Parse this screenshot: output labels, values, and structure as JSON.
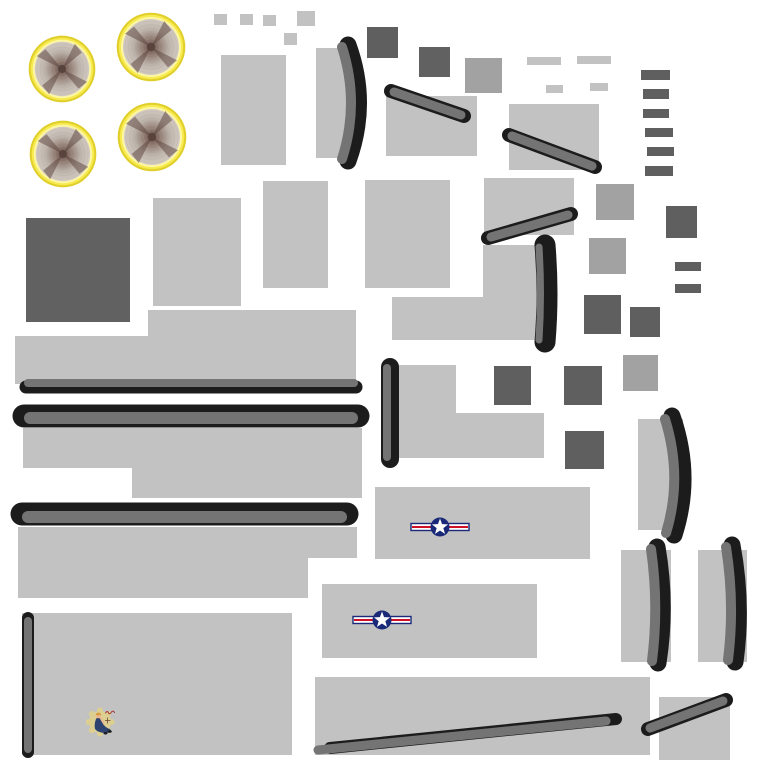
{
  "canvas": {
    "width": 768,
    "height": 768,
    "background": "#ffffff"
  },
  "palette": {
    "light": "#C2C2C2",
    "mid": "#A2A2A2",
    "dark": "#5F5F5F",
    "darker": "#616161",
    "strip": "#747474",
    "black": "#1C1C1C",
    "yellow_edge": "#E0CF2B",
    "yellow_ring": "#F7EA4F",
    "yellow_hi": "#FDF6A3",
    "disc_core": "#6E534B",
    "disc_mid": "#917C72",
    "disc_outer": "#D2CAC2",
    "ring_line": "#AFA49C",
    "prop_blur": "#5A423B",
    "insignia_blue": "#1B2A78",
    "insignia_red": "#CE1126",
    "insignia_white": "#FFFFFF",
    "gear_tan": "#DCCF90",
    "uniform_navy": "#2E4470",
    "skin": "#EBB98F",
    "hair": "#D79A3C",
    "script_red": "#A83232",
    "shoe_black": "#1A1A1A"
  },
  "engines": [
    {
      "cx": 62,
      "cy": 69,
      "r": 34
    },
    {
      "cx": 151,
      "cy": 47,
      "r": 35
    },
    {
      "cx": 63,
      "cy": 154,
      "r": 34
    },
    {
      "cx": 152,
      "cy": 137,
      "r": 35
    }
  ],
  "rects": [
    {
      "x": 214,
      "y": 14,
      "w": 13,
      "h": 11,
      "c": "light",
      "n": "small-panel-patch"
    },
    {
      "x": 240,
      "y": 14,
      "w": 13,
      "h": 11,
      "c": "light",
      "n": "small-panel-patch"
    },
    {
      "x": 263,
      "y": 15,
      "w": 13,
      "h": 11,
      "c": "light",
      "n": "small-panel-patch"
    },
    {
      "x": 297,
      "y": 11,
      "w": 18,
      "h": 15,
      "c": "light",
      "n": "small-panel-patch"
    },
    {
      "x": 284,
      "y": 33,
      "w": 13,
      "h": 12,
      "c": "light",
      "n": "small-panel-patch"
    },
    {
      "x": 221,
      "y": 55,
      "w": 65,
      "h": 110,
      "c": "light",
      "n": "panel-patch"
    },
    {
      "x": 316,
      "y": 48,
      "w": 40,
      "h": 110,
      "c": "light",
      "n": "blade-backing-patch"
    },
    {
      "x": 367,
      "y": 27,
      "w": 31,
      "h": 31,
      "c": "dark",
      "n": "dark-panel-patch"
    },
    {
      "x": 419,
      "y": 47,
      "w": 31,
      "h": 30,
      "c": "darker",
      "n": "dark-panel-patch"
    },
    {
      "x": 465,
      "y": 58,
      "w": 37,
      "h": 35,
      "c": "mid",
      "n": "mid-panel-patch"
    },
    {
      "x": 386,
      "y": 96,
      "w": 91,
      "h": 60,
      "c": "light",
      "n": "panel-patch"
    },
    {
      "x": 509,
      "y": 104,
      "w": 90,
      "h": 66,
      "c": "light",
      "n": "panel-patch"
    },
    {
      "x": 527,
      "y": 57,
      "w": 34,
      "h": 8,
      "c": "light",
      "n": "thin-panel-strip"
    },
    {
      "x": 577,
      "y": 56,
      "w": 34,
      "h": 8,
      "c": "light",
      "n": "thin-panel-strip"
    },
    {
      "x": 546,
      "y": 85,
      "w": 17,
      "h": 8,
      "c": "light",
      "n": "thin-panel-strip"
    },
    {
      "x": 590,
      "y": 83,
      "w": 18,
      "h": 8,
      "c": "light",
      "n": "thin-panel-strip"
    },
    {
      "x": 641,
      "y": 70,
      "w": 29,
      "h": 10,
      "c": "dark",
      "n": "dark-slat-patch"
    },
    {
      "x": 643,
      "y": 89,
      "w": 26,
      "h": 10,
      "c": "dark",
      "n": "dark-slat-patch"
    },
    {
      "x": 643,
      "y": 109,
      "w": 26,
      "h": 9,
      "c": "dark",
      "n": "dark-slat-patch"
    },
    {
      "x": 645,
      "y": 128,
      "w": 28,
      "h": 9,
      "c": "dark",
      "n": "dark-slat-patch"
    },
    {
      "x": 647,
      "y": 147,
      "w": 27,
      "h": 9,
      "c": "dark",
      "n": "dark-slat-patch"
    },
    {
      "x": 645,
      "y": 166,
      "w": 28,
      "h": 10,
      "c": "dark",
      "n": "dark-slat-patch"
    },
    {
      "x": 26,
      "y": 218,
      "w": 104,
      "h": 104,
      "c": "darker",
      "n": "large-dark-panel-patch"
    },
    {
      "x": 153,
      "y": 198,
      "w": 88,
      "h": 108,
      "c": "light",
      "n": "panel-patch"
    },
    {
      "x": 263,
      "y": 181,
      "w": 65,
      "h": 107,
      "c": "light",
      "n": "panel-patch"
    },
    {
      "x": 365,
      "y": 180,
      "w": 85,
      "h": 108,
      "c": "light",
      "n": "panel-patch"
    },
    {
      "x": 484,
      "y": 178,
      "w": 90,
      "h": 57,
      "c": "light",
      "n": "panel-patch"
    },
    {
      "x": 596,
      "y": 184,
      "w": 38,
      "h": 36,
      "c": "mid",
      "n": "mid-panel-patch"
    },
    {
      "x": 666,
      "y": 206,
      "w": 31,
      "h": 32,
      "c": "dark",
      "n": "dark-panel-patch"
    },
    {
      "x": 589,
      "y": 238,
      "w": 37,
      "h": 36,
      "c": "mid",
      "n": "mid-panel-patch"
    },
    {
      "x": 675,
      "y": 262,
      "w": 26,
      "h": 9,
      "c": "dark",
      "n": "dark-slat-patch"
    },
    {
      "x": 675,
      "y": 284,
      "w": 26,
      "h": 9,
      "c": "dark",
      "n": "dark-slat-patch"
    },
    {
      "x": 584,
      "y": 295,
      "w": 37,
      "h": 39,
      "c": "dark",
      "n": "dark-panel-patch"
    },
    {
      "x": 630,
      "y": 307,
      "w": 30,
      "h": 30,
      "c": "dark",
      "n": "dark-panel-patch"
    },
    {
      "x": 148,
      "y": 310,
      "w": 208,
      "h": 26,
      "c": "light",
      "n": "wing-panel-patch"
    },
    {
      "x": 15,
      "y": 336,
      "w": 341,
      "h": 48,
      "c": "light",
      "n": "wing-panel-patch"
    },
    {
      "x": 23,
      "y": 428,
      "w": 339,
      "h": 40,
      "c": "light",
      "n": "wing-panel-patch"
    },
    {
      "x": 132,
      "y": 468,
      "w": 230,
      "h": 30,
      "c": "light",
      "n": "wing-panel-patch"
    },
    {
      "x": 18,
      "y": 527,
      "w": 339,
      "h": 31,
      "c": "light",
      "n": "wing-panel-patch"
    },
    {
      "x": 18,
      "y": 558,
      "w": 290,
      "h": 40,
      "c": "light",
      "n": "wing-panel-patch"
    },
    {
      "x": 390,
      "y": 365,
      "w": 66,
      "h": 48,
      "c": "light",
      "n": "panel-patch"
    },
    {
      "x": 390,
      "y": 413,
      "w": 154,
      "h": 45,
      "c": "light",
      "n": "panel-patch"
    },
    {
      "x": 483,
      "y": 245,
      "w": 53,
      "h": 95,
      "c": "light",
      "n": "panel-patch"
    },
    {
      "x": 392,
      "y": 297,
      "w": 144,
      "h": 43,
      "c": "light",
      "n": "panel-patch"
    },
    {
      "x": 494,
      "y": 366,
      "w": 37,
      "h": 39,
      "c": "dark",
      "n": "dark-panel-patch"
    },
    {
      "x": 564,
      "y": 366,
      "w": 38,
      "h": 39,
      "c": "dark",
      "n": "dark-panel-patch"
    },
    {
      "x": 623,
      "y": 355,
      "w": 35,
      "h": 36,
      "c": "mid",
      "n": "mid-panel-patch"
    },
    {
      "x": 565,
      "y": 431,
      "w": 39,
      "h": 38,
      "c": "dark",
      "n": "dark-panel-patch"
    },
    {
      "x": 375,
      "y": 487,
      "w": 215,
      "h": 72,
      "c": "light",
      "n": "fuselage-panel-patch"
    },
    {
      "x": 322,
      "y": 584,
      "w": 215,
      "h": 74,
      "c": "light",
      "n": "fuselage-panel-patch"
    },
    {
      "x": 638,
      "y": 419,
      "w": 45,
      "h": 111,
      "c": "light",
      "n": "blade-backing-patch"
    },
    {
      "x": 621,
      "y": 550,
      "w": 50,
      "h": 112,
      "c": "light",
      "n": "blade-backing-patch"
    },
    {
      "x": 698,
      "y": 550,
      "w": 49,
      "h": 112,
      "c": "light",
      "n": "blade-backing-patch"
    },
    {
      "x": 22,
      "y": 613,
      "w": 270,
      "h": 142,
      "c": "light",
      "n": "nose-panel-patch"
    },
    {
      "x": 315,
      "y": 677,
      "w": 335,
      "h": 78,
      "c": "light",
      "n": "panel-patch"
    },
    {
      "x": 659,
      "y": 697,
      "w": 71,
      "h": 63,
      "c": "light",
      "n": "panel-patch"
    }
  ],
  "blades": [
    {
      "base": "M348,45 Q369,103 348,161",
      "top": "M342,47 Q360,103 342,159",
      "bw": 17,
      "tw": 10
    },
    {
      "base": "M545,245 Q549,294 545,342",
      "top": "M539,247 Q542,294 539,340",
      "bw": 21,
      "tw": 7
    },
    {
      "base": "M672,416 Q693,476 674,535",
      "top": "M665,419 Q683,477 666,533",
      "bw": 17,
      "tw": 10
    },
    {
      "base": "M657,547 Q667,605 658,663",
      "top": "M651,549 Q659,605 652,661",
      "bw": 17,
      "tw": 10
    },
    {
      "base": "M732,545 Q743,604 735,662",
      "top": "M726,547 Q735,604 728,660",
      "bw": 17,
      "tw": 10
    }
  ],
  "strips": [
    {
      "base": [
        391,
        91,
        464,
        116,
        14
      ],
      "top": [
        394,
        92,
        461,
        115,
        9
      ],
      "n": "edge-strip"
    },
    {
      "base": [
        509,
        135,
        595,
        167,
        14
      ],
      "top": [
        512,
        136,
        592,
        166,
        9
      ],
      "n": "edge-strip"
    },
    {
      "base": [
        488,
        238,
        571,
        214,
        14
      ],
      "top": [
        491,
        237,
        568,
        215,
        9
      ],
      "n": "edge-strip"
    },
    {
      "base": [
        390,
        367,
        390,
        459,
        18
      ],
      "top": [
        387,
        368,
        387,
        457,
        8
      ],
      "n": "edge-strip"
    },
    {
      "base": [
        26,
        387,
        356,
        387,
        13
      ],
      "top": [
        28,
        383,
        354,
        383,
        8
      ],
      "n": "wing-leading-edge-strip"
    },
    {
      "base": [
        24,
        416,
        358,
        416,
        23
      ],
      "top": [
        30,
        418,
        352,
        418,
        12
      ],
      "n": "wing-leading-edge-strip"
    },
    {
      "base": [
        22,
        514,
        347,
        514,
        23
      ],
      "top": [
        28,
        517,
        341,
        517,
        12
      ],
      "n": "wing-leading-edge-strip"
    },
    {
      "base": [
        28,
        618,
        28,
        752,
        12
      ],
      "top": [
        28,
        621,
        28,
        749,
        8
      ],
      "n": "edge-strip"
    },
    {
      "base": [
        330,
        748,
        616,
        719,
        12
      ],
      "top": [
        318,
        750,
        606,
        721,
        9
      ],
      "n": "edge-strip"
    },
    {
      "base": [
        648,
        729,
        726,
        700,
        14
      ],
      "top": [
        650,
        728,
        723,
        701,
        9
      ],
      "n": "edge-strip"
    }
  ],
  "insignias": [
    {
      "cx": 440,
      "cy": 527,
      "w": 60,
      "h": 20
    },
    {
      "cx": 382,
      "cy": 620,
      "w": 60,
      "h": 20
    }
  ],
  "nose_art": {
    "x": 86,
    "y": 702,
    "w": 36,
    "h": 36
  }
}
